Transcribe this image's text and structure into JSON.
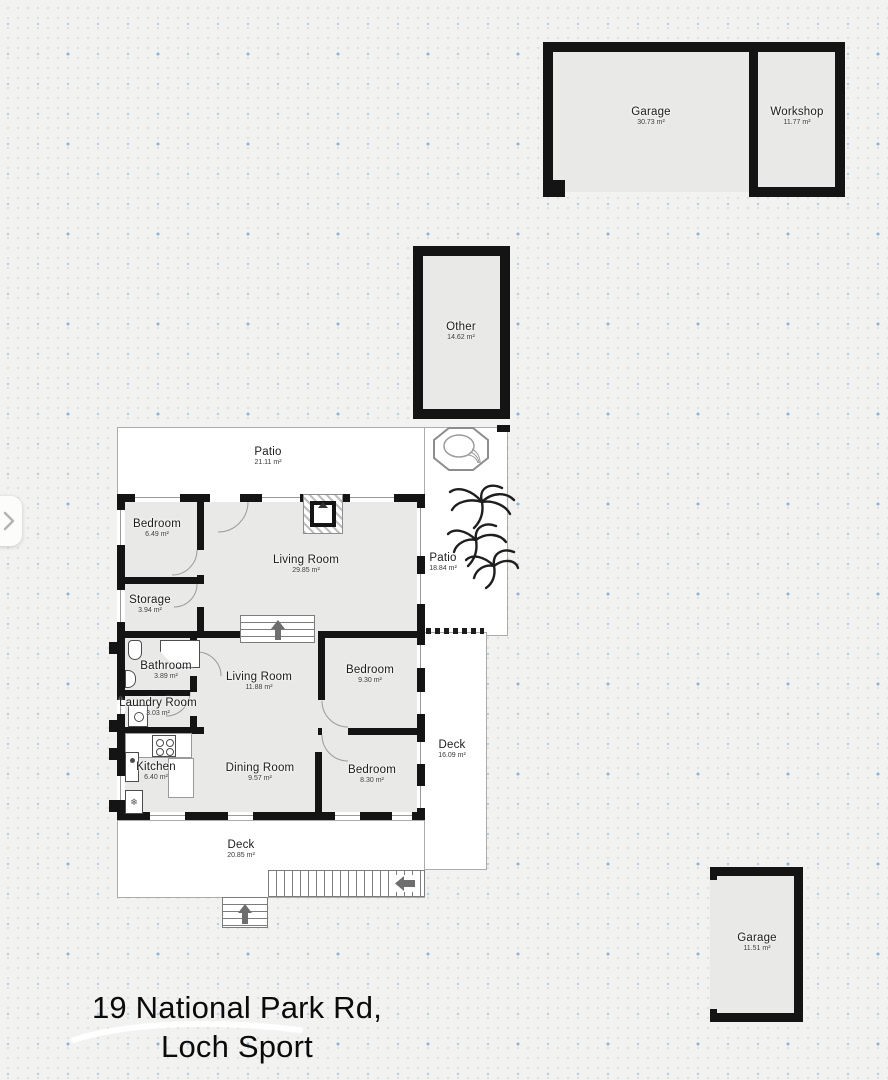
{
  "title": {
    "line1": "19 National Park Rd,",
    "line2": "Loch Sport"
  },
  "colors": {
    "wall": "#141414",
    "room_fill": "#e9e9e7",
    "outdoor_fill": "#ffffff",
    "background": "#f2f2f0",
    "dot_gray": "#d8d8d4",
    "dot_blue": "#8fb4da",
    "label_text": "#1b1b1b",
    "arrow_gray": "#6e6e6e"
  },
  "icons": {
    "nav": "chevron-right-icon",
    "outdoor": [
      "hot-tub-illustration",
      "palm-trees-illustration"
    ],
    "stairs": [
      "arrow-up-icon",
      "arrow-left-icon"
    ],
    "fireplace": "fireplace-icon",
    "appliance_glyph": "❄"
  },
  "rooms": [
    {
      "id": "garage-top",
      "name": "Garage",
      "area": "30.73 m²"
    },
    {
      "id": "workshop",
      "name": "Workshop",
      "area": "11.77 m²"
    },
    {
      "id": "other",
      "name": "Other",
      "area": "14.62 m²"
    },
    {
      "id": "patio-top",
      "name": "Patio",
      "area": "21.11 m²"
    },
    {
      "id": "bedroom-top",
      "name": "Bedroom",
      "area": "6.49 m²"
    },
    {
      "id": "living-room-main",
      "name": "Living Room",
      "area": "29.85 m²"
    },
    {
      "id": "patio-right",
      "name": "Patio",
      "area": "18.84 m²"
    },
    {
      "id": "storage",
      "name": "Storage",
      "area": "3.94 m²"
    },
    {
      "id": "bathroom",
      "name": "Bathroom",
      "area": "3.89 m²"
    },
    {
      "id": "living-room-2",
      "name": "Living Room",
      "area": "11.88 m²"
    },
    {
      "id": "bedroom-middle",
      "name": "Bedroom",
      "area": "9.30 m²"
    },
    {
      "id": "laundry-room",
      "name": "Laundry Room",
      "area": "3.03 m²"
    },
    {
      "id": "deck-right",
      "name": "Deck",
      "area": "16.09 m²"
    },
    {
      "id": "kitchen",
      "name": "Kitchen",
      "area": "6.40 m²"
    },
    {
      "id": "dining-room",
      "name": "Dining Room",
      "area": "9.57 m²"
    },
    {
      "id": "bedroom-bottom",
      "name": "Bedroom",
      "area": "8.30 m²"
    },
    {
      "id": "deck-bottom",
      "name": "Deck",
      "area": "20.85 m²"
    },
    {
      "id": "garage-bottom",
      "name": "Garage",
      "area": "11.51 m²"
    }
  ]
}
